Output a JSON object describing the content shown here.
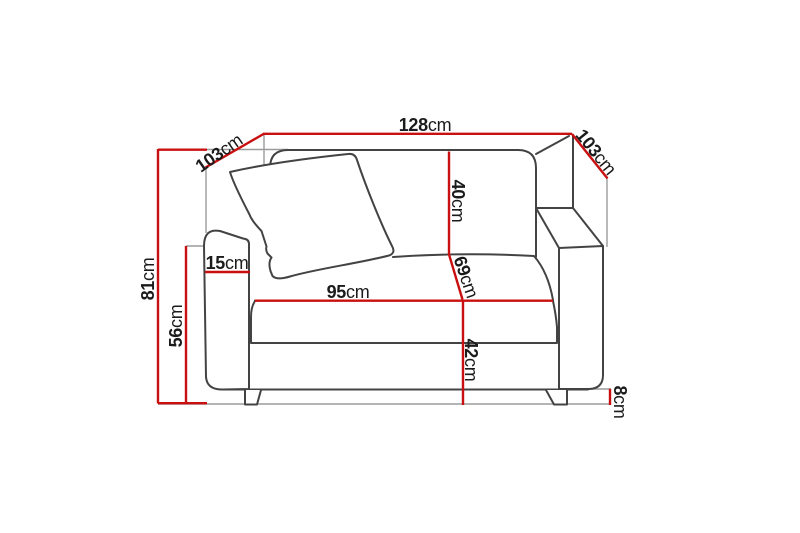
{
  "diagram": {
    "type": "furniture-dimension-diagram",
    "subject": "Two-seater sofa (loveseat) front view with a throw pillow and dimension annotations",
    "unit": "cm",
    "colors": {
      "dimension_line": "#c90f0f",
      "sofa_outline": "#434343",
      "extension_line": "#9b9b9b",
      "label_text": "#1b1b1b",
      "background": "#ffffff"
    },
    "dimensions": [
      {
        "id": "overall-width",
        "value": "128",
        "unit": "cm",
        "orientation": "horizontal-top"
      },
      {
        "id": "depth-left",
        "value": "103",
        "unit": "cm",
        "orientation": "diagonal-left"
      },
      {
        "id": "depth-right",
        "value": "103",
        "unit": "cm",
        "orientation": "diagonal-right"
      },
      {
        "id": "overall-height",
        "value": "81",
        "unit": "cm",
        "orientation": "vertical-left"
      },
      {
        "id": "armrest-height",
        "value": "56",
        "unit": "cm",
        "orientation": "vertical-left"
      },
      {
        "id": "armrest-width",
        "value": "15",
        "unit": "cm",
        "orientation": "horizontal"
      },
      {
        "id": "seat-width",
        "value": "95",
        "unit": "cm",
        "orientation": "horizontal"
      },
      {
        "id": "backrest-height",
        "value": "40",
        "unit": "cm",
        "orientation": "vertical"
      },
      {
        "id": "seat-depth",
        "value": "69",
        "unit": "cm",
        "orientation": "diagonal"
      },
      {
        "id": "seat-height",
        "value": "42",
        "unit": "cm",
        "orientation": "vertical"
      },
      {
        "id": "leg-height",
        "value": "8",
        "unit": "cm",
        "orientation": "vertical-right"
      }
    ]
  }
}
